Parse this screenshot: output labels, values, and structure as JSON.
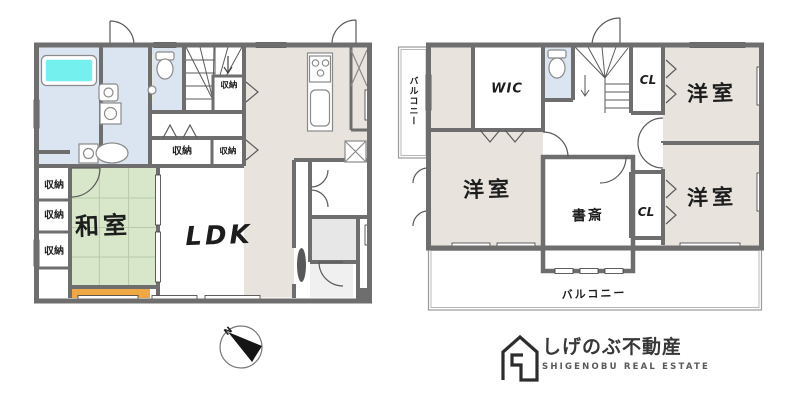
{
  "colors": {
    "wall": "#6e6e6e",
    "beige": "#e9e3dd",
    "wet_blue": "#dbe5f1",
    "tatami_green": "#d8e7ca",
    "tub_cyan": "#74f0ee",
    "engawa_orange": "#f0a845",
    "entry_gray": "#e7e7e7",
    "genkan_gray": "#f0f0f0",
    "pale_yellow": "#f1eec6",
    "balcony_border": "#9a9a9a",
    "line": "#555555",
    "logo_dark": "#2d2d2d"
  },
  "floor1": {
    "labels": {
      "ldk": "LDK",
      "japanese_room": "和室",
      "storage_under_stairs": "収納",
      "storage_hall_left": "収納",
      "storage_hall_right": "収納",
      "storage_west_1": "収納",
      "storage_west_2": "収納",
      "storage_west_3": "収納"
    }
  },
  "floor2": {
    "labels": {
      "balcony_left": "バルコニー",
      "wic": "WIC",
      "closet_top": "CL",
      "closet_bottom": "CL",
      "bedroom_top_right": "洋室",
      "bedroom_left": "洋室",
      "bedroom_bottom_right": "洋室",
      "study": "書斎",
      "balcony_bottom": "バルコニー"
    }
  },
  "compass": {
    "north": "N"
  },
  "logo": {
    "company": "しげのぶ不動産",
    "company_en": "SHIGENOBU REAL ESTATE"
  }
}
